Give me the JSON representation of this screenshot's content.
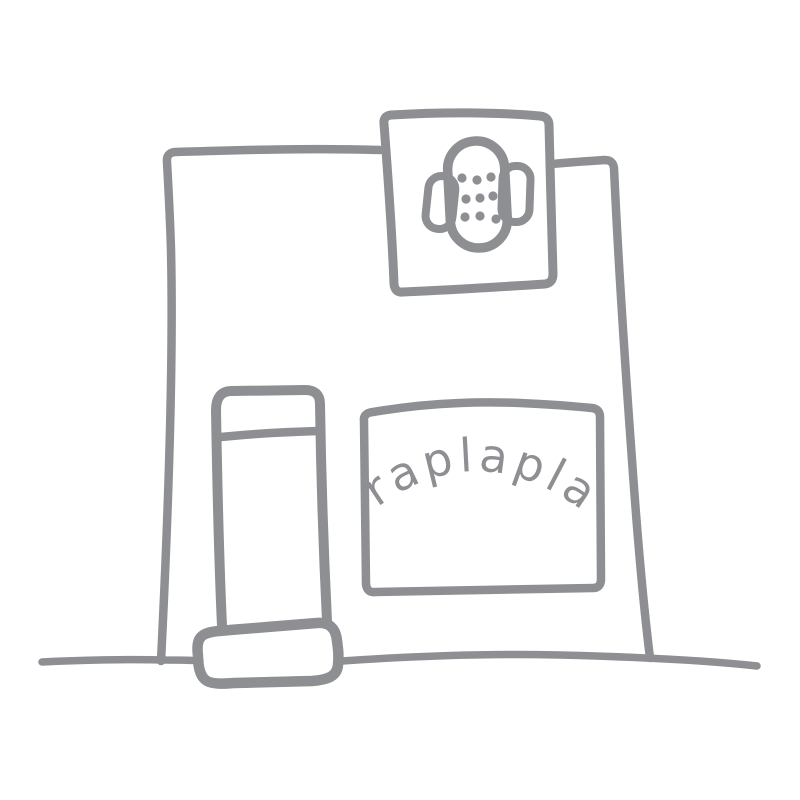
{
  "colors": {
    "background": "#ffffff",
    "line": "#8e8f93"
  },
  "storefront": {
    "sign_text": "raplapla",
    "hanging_sign_icon": "bandage-icon",
    "bandage_dot_count": 9
  }
}
